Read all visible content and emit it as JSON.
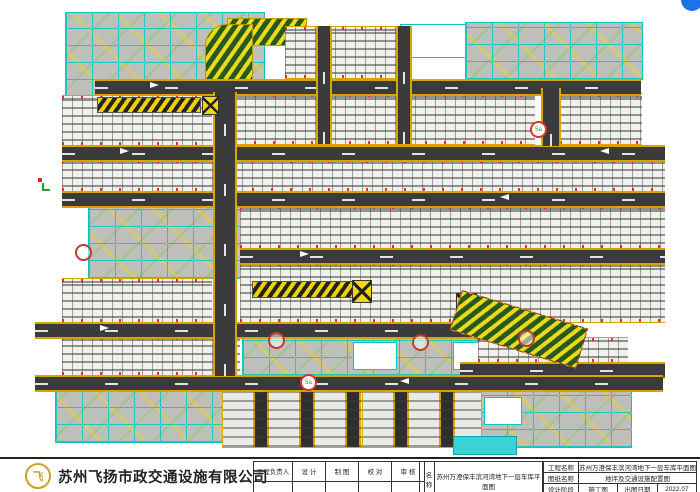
{
  "drawing": {
    "markers": [
      {
        "label": "5a"
      },
      {
        "label": "5a"
      }
    ],
    "legend_colors": {
      "road": "#3b3b3b",
      "lane_edge_yellow": "#d9a400",
      "ramp_yellow": "#ecd91c",
      "ramp_green": "#265a1c",
      "room_outline_cyan": "#00c8c8",
      "wheel_stop_red": "#dd2a1e",
      "water_tank_cyan": "#3ad2d2",
      "floating_button_blue": "#1a73e8"
    }
  },
  "title_block": {
    "company": {
      "name": "苏州飞扬市政交通设施有限公司",
      "logo_glyph": "飞"
    },
    "signature_table": {
      "headers": [
        "工程负责人",
        "设 计",
        "制 图",
        "校 对",
        "审 核"
      ]
    },
    "name_section": {
      "label": "名称",
      "value": "苏州万澄保丰滨河湾地下一层车库平面图"
    },
    "info_table": {
      "rows": [
        {
          "label": "工程名称",
          "value": "苏州万澄保丰滨河湾地下一层车库平面图"
        },
        {
          "label": "图纸名称",
          "value": "地坪及交通设施配置图"
        },
        {
          "label": "设计阶段",
          "value": "施工图",
          "label2": "出图日期",
          "value2": "2022.07"
        }
      ]
    }
  }
}
